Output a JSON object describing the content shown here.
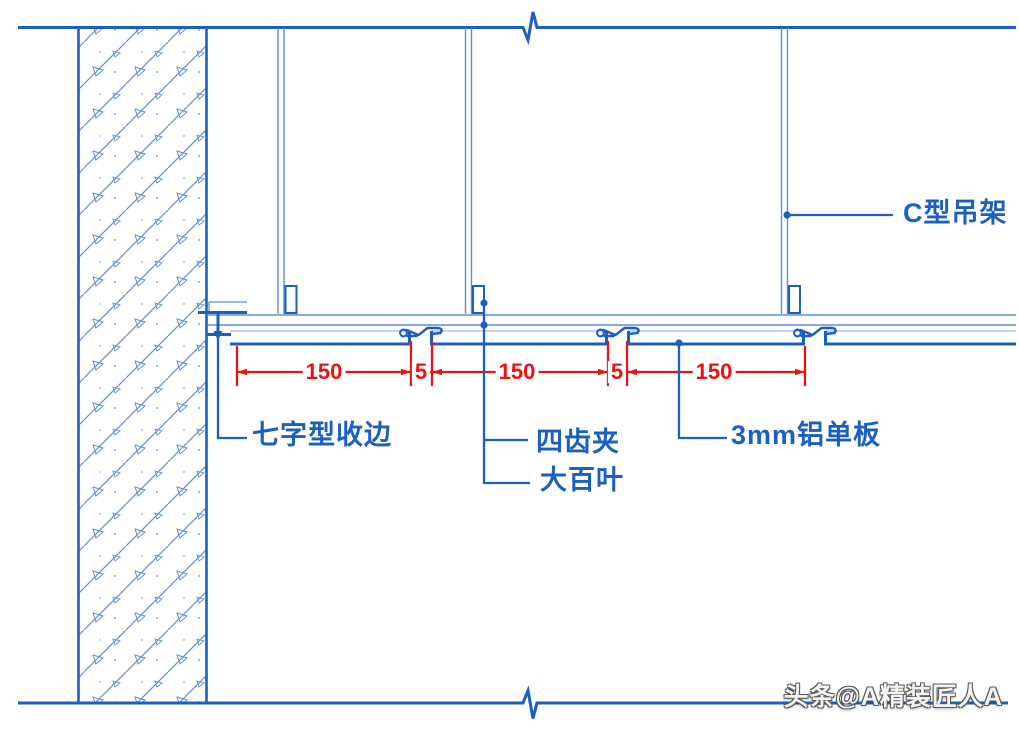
{
  "labels": {
    "c_hanger": "C型吊架",
    "edge_trim": "七字型收边",
    "tooth_clip": "四齿夹",
    "louver": "大百叶",
    "alum_panel": "3mm铝单板"
  },
  "dimensions": [
    "150",
    "5",
    "150",
    "5",
    "150"
  ],
  "watermark": "头条@A精装匠人A",
  "colors": {
    "line_blue": "#1B5FC1",
    "thin_blue": "#5E8FD6",
    "dim_red": "#EE1111"
  }
}
